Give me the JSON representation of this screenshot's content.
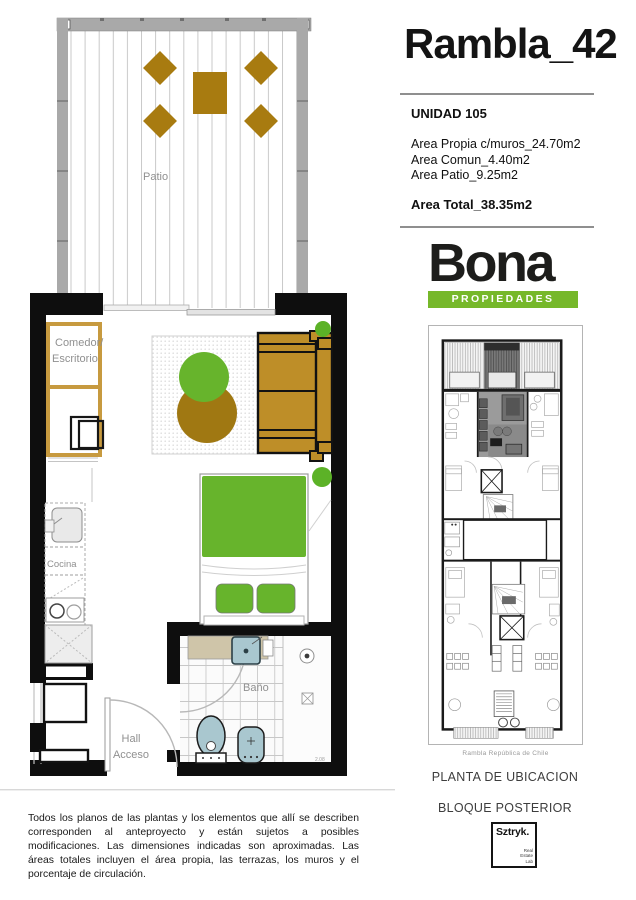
{
  "header": {
    "title": "Rambla_42"
  },
  "unit_info": {
    "name": "UNIDAD 105",
    "areas": [
      "Area Propia c/muros_24.70m2",
      "Area Comun_4.40m2",
      "Area Patio_9.25m2"
    ],
    "total": "Area Total_38.35m2"
  },
  "brand": {
    "name": "Bona",
    "tagline": "PROPIEDADES",
    "green": "#76B82A",
    "black": "#1d1d1b"
  },
  "location_plan": {
    "street": "Rambla República de Chile",
    "caption_line1": "PLANTA DE UBICACION",
    "caption_line2": "BLOQUE POSTERIOR"
  },
  "studio": {
    "name": "Sztryk.",
    "sub": [
      "Real",
      "Estate",
      "Lab"
    ]
  },
  "floorplan": {
    "labels": {
      "patio": "Patio",
      "dining1": "Comedor/",
      "dining2": "Escritorio",
      "kitchen": "Cocina",
      "hall1": "Hall",
      "hall2": "Acceso",
      "bath": "Baño",
      "dim": "2.08"
    },
    "colors": {
      "wall": "#0e0e0e",
      "patio_wall": "#a9a9a9",
      "wood": "#A87B10",
      "sofa": "#BE8E28",
      "green": "#67B42C",
      "plant_brown": "#A07812",
      "fixture_blue": "#A9C7CF",
      "vanity_beige": "#CFC5A9"
    }
  },
  "disclaimer": "Todos los planos de las plantas y los elementos que allí se describen corresponden al anteproyecto y están sujetos a posibles modificaciones. Las dimensiones indicadas son aproximadas. Las áreas totales incluyen el área propia, las terrazas, los muros y el porcentaje de circulación."
}
